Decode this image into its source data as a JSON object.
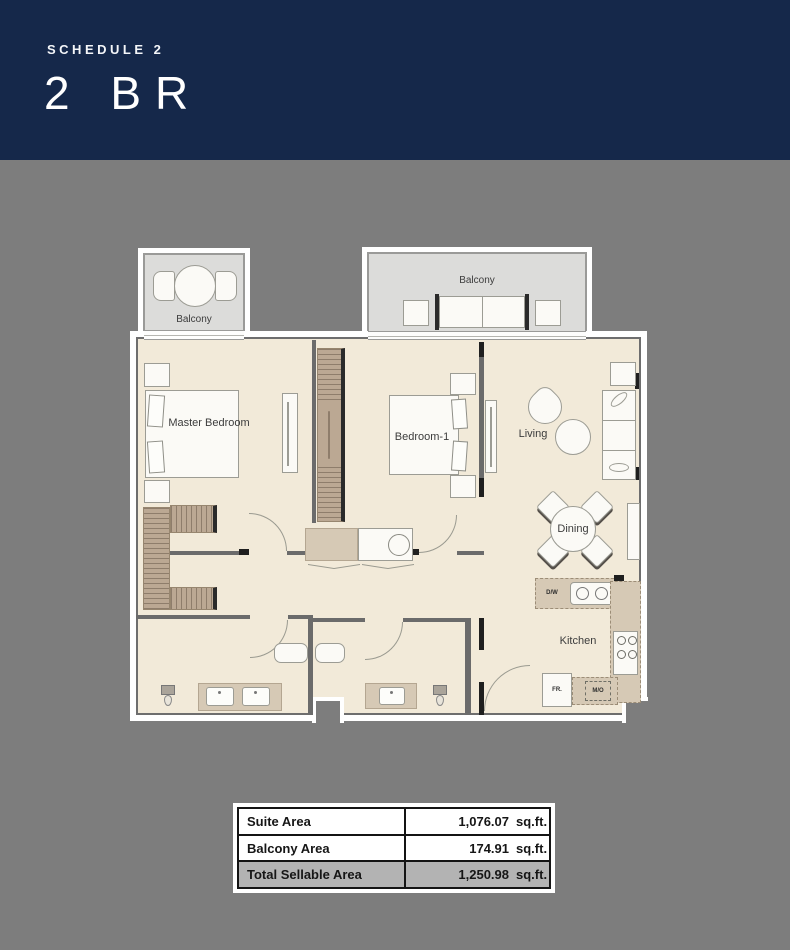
{
  "header": {
    "schedule_label": "SCHEDULE 2",
    "title": "2 BR"
  },
  "plan": {
    "labels": {
      "balcony_left": "Balcony",
      "balcony_main": "Balcony",
      "master_bedroom": "Master Bedroom",
      "bedroom_1": "Bedroom-1",
      "living": "Living",
      "dining": "Dining",
      "kitchen": "Kitchen",
      "dishwasher": "D/W",
      "fridge": "FR.",
      "microwave": "M/O"
    }
  },
  "area_table": {
    "rows": [
      {
        "label": "Suite Area",
        "value": "1,076.07",
        "unit": "sq.ft."
      },
      {
        "label": "Balcony Area",
        "value": "174.91",
        "unit": "sq.ft."
      },
      {
        "label": "Total Sellable Area",
        "value": "1,250.98",
        "unit": "sq.ft."
      }
    ]
  },
  "colors": {
    "header_bg": "#15284a",
    "page_bg": "#7d7d7d",
    "floor": "#f2ead9",
    "balcony": "#dcdcda",
    "wardrobe": "#bba893",
    "counter": "#d6c9b5",
    "wall": "#6b6b6b",
    "wall_dark": "#1f1f1f"
  }
}
